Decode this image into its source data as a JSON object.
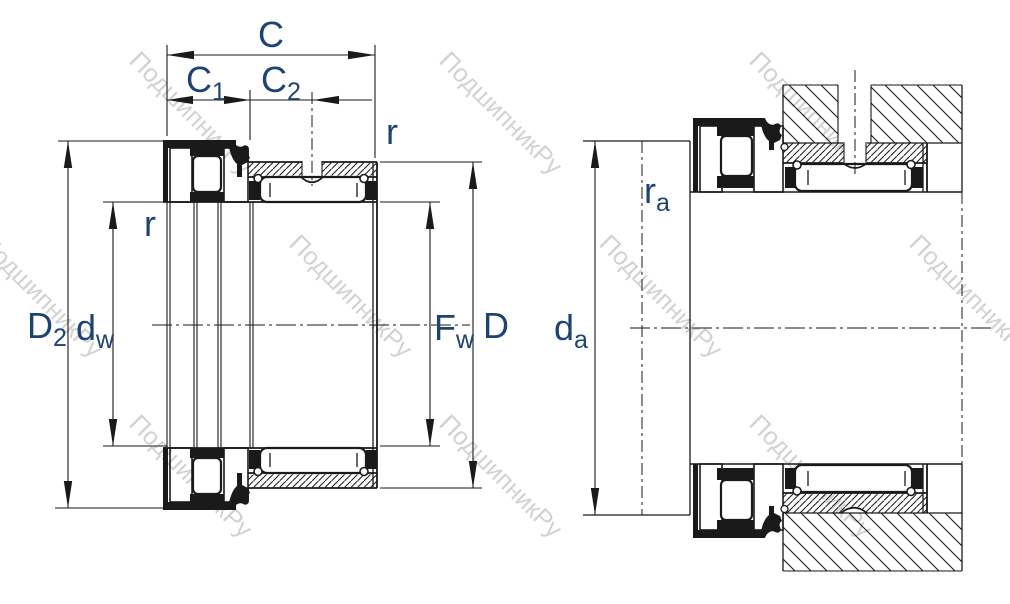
{
  "labels": {
    "c": "C",
    "c1_base": "C",
    "c1_sub": "1",
    "c2_base": "C",
    "c2_sub": "2",
    "r_upper": "r",
    "r_lower": "r",
    "d2_base": "D",
    "d2_sub": "2",
    "dw_base": "d",
    "dw_sub": "w",
    "fw_base": "F",
    "fw_sub": "w",
    "d": "D",
    "da_base": "d",
    "da_sub": "a",
    "ra_base": "r",
    "ra_sub": "a"
  },
  "watermark": {
    "text": "ПодшипникРу",
    "color": "#d2d2d2"
  },
  "colors": {
    "line": "#1a1a1a",
    "label": "#1d4373",
    "background": "#ffffff"
  }
}
